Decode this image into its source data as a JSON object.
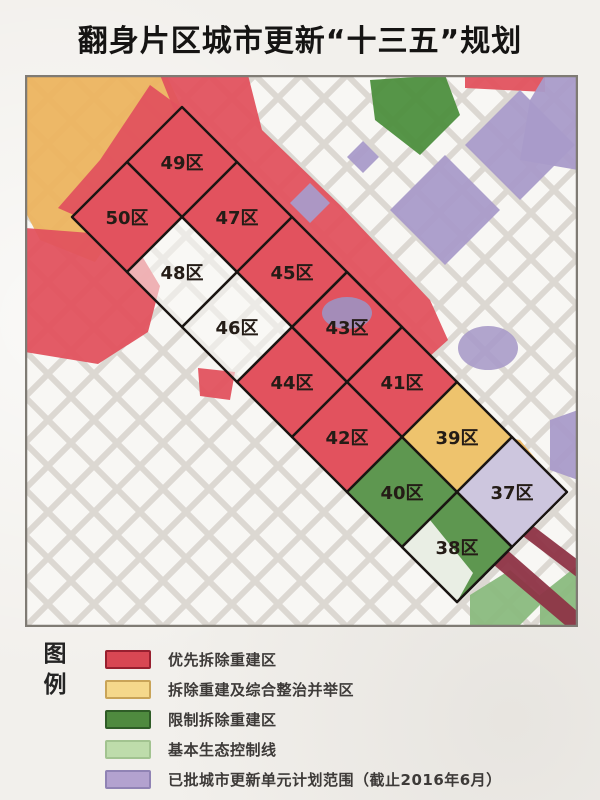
{
  "title": "翻身片区城市更新“十三五”规划",
  "legend": {
    "heading": [
      "图",
      "例"
    ],
    "items": [
      {
        "label": "优先拆除重建区",
        "fill": "#d84753",
        "border": "#97202f"
      },
      {
        "label": "拆除重建及综合整治并举区",
        "fill": "#f5d88b",
        "border": "#c9a458"
      },
      {
        "label": "限制拆除重建区",
        "fill": "#4f8a3f",
        "border": "#2f5c27"
      },
      {
        "label": "基本生态控制线",
        "fill": "#bedcab",
        "border": "#a2c390"
      },
      {
        "label": "已批城市更新单元计划范围（截止2016年6月）",
        "fill": "#b3a2cf",
        "border": "#9083b4"
      }
    ]
  },
  "map": {
    "districts": [
      {
        "label": "49区",
        "row": 0,
        "col": 0,
        "category": "priority"
      },
      {
        "label": "47区",
        "row": 0,
        "col": 1,
        "category": "priority"
      },
      {
        "label": "45区",
        "row": 0,
        "col": 2,
        "category": "priority"
      },
      {
        "label": "43区",
        "row": 0,
        "col": 3,
        "category": "priority",
        "overlay": "purple-blob"
      },
      {
        "label": "41区",
        "row": 0,
        "col": 4,
        "category": "priority"
      },
      {
        "label": "39区",
        "row": 0,
        "col": 5,
        "category": "mixed"
      },
      {
        "label": "37区",
        "row": 0,
        "col": 6,
        "category": "planned"
      },
      {
        "label": "50区",
        "row": 1,
        "col": 0,
        "category": "priority"
      },
      {
        "label": "48区",
        "row": 1,
        "col": 1,
        "category": "street"
      },
      {
        "label": "46区",
        "row": 1,
        "col": 2,
        "category": "street"
      },
      {
        "label": "44区",
        "row": 1,
        "col": 3,
        "category": "priority"
      },
      {
        "label": "42区",
        "row": 1,
        "col": 4,
        "category": "priority"
      },
      {
        "label": "40区",
        "row": 1,
        "col": 5,
        "category": "restricted"
      },
      {
        "label": "38区",
        "row": 1,
        "col": 6,
        "category": "restricted",
        "overlay": "white-lower-left"
      }
    ],
    "palette": {
      "priority": "#e2525e",
      "mixed": "#eec36d",
      "restricted": "#5e9750",
      "street": "rgba(250,249,246,0.55)",
      "planned": "#cdc6de"
    },
    "background_palette": {
      "orange": "#ecb45f",
      "red": "#e2525e",
      "green_block": "#4d8f3e",
      "purple": "#a99bc9",
      "purple_blob": "#9d92c2",
      "maroon": "#8e3446",
      "br_green": "#8abb7e",
      "street_bg": "#f8f7f4",
      "street_line": "#dcd8d2",
      "grid_line": "#1a1512",
      "label": "#241c16",
      "border": "#7f7b74"
    }
  }
}
